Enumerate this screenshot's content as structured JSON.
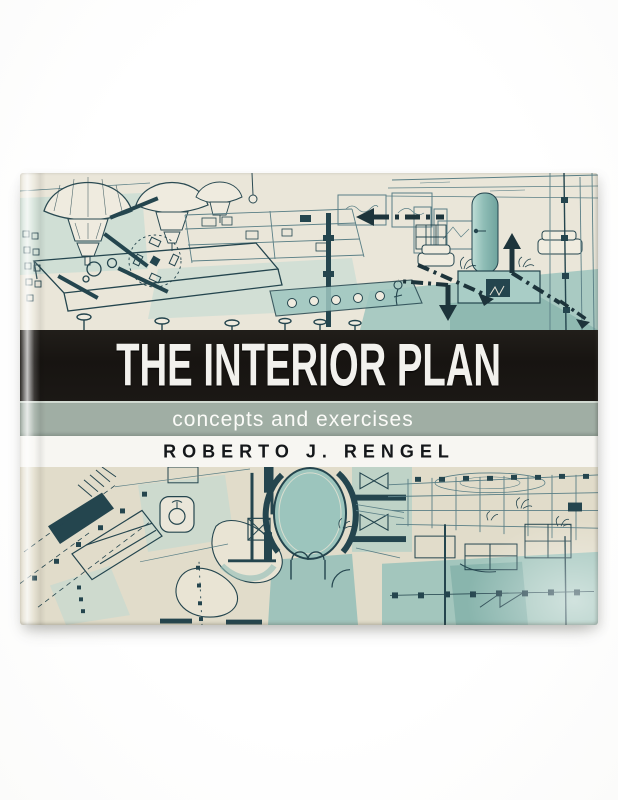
{
  "scene": {
    "description": "Photograph of a landscape-format softcover book lying on a plain white background",
    "backdrop_color": "#ffffff"
  },
  "book": {
    "title": "THE INTERIOR PLAN",
    "subtitle": "concepts and exercises",
    "author": "ROBERTO J. RENGEL",
    "colors": {
      "title_band_bg": "#171411",
      "title_text": "#f2f1ed",
      "subtitle_band_bg": "#a0aea4",
      "subtitle_text": "#fbfbf8",
      "author_band_bg": "#f7f6f2",
      "author_text": "#14171a",
      "paper_cream_top": "#eae6d9",
      "paper_cream_bottom": "#e1dcca",
      "sketch_ink_dark": "#24454e",
      "sketch_ink_mid": "#5a7f86",
      "wash_teal_light": "#b9d8d2",
      "wash_teal_mid": "#93c0b9",
      "wash_teal_strong": "#6fa39d"
    },
    "illustrations": {
      "top_alt": "teal ink perspective sketch of an interior with pendant lamps, shelving, counter, fireplace and bold dash-dot circulation arrows",
      "bottom_alt": "teal ink floor-plan sketch with an oval room beside a furnished interior section perspective"
    }
  }
}
